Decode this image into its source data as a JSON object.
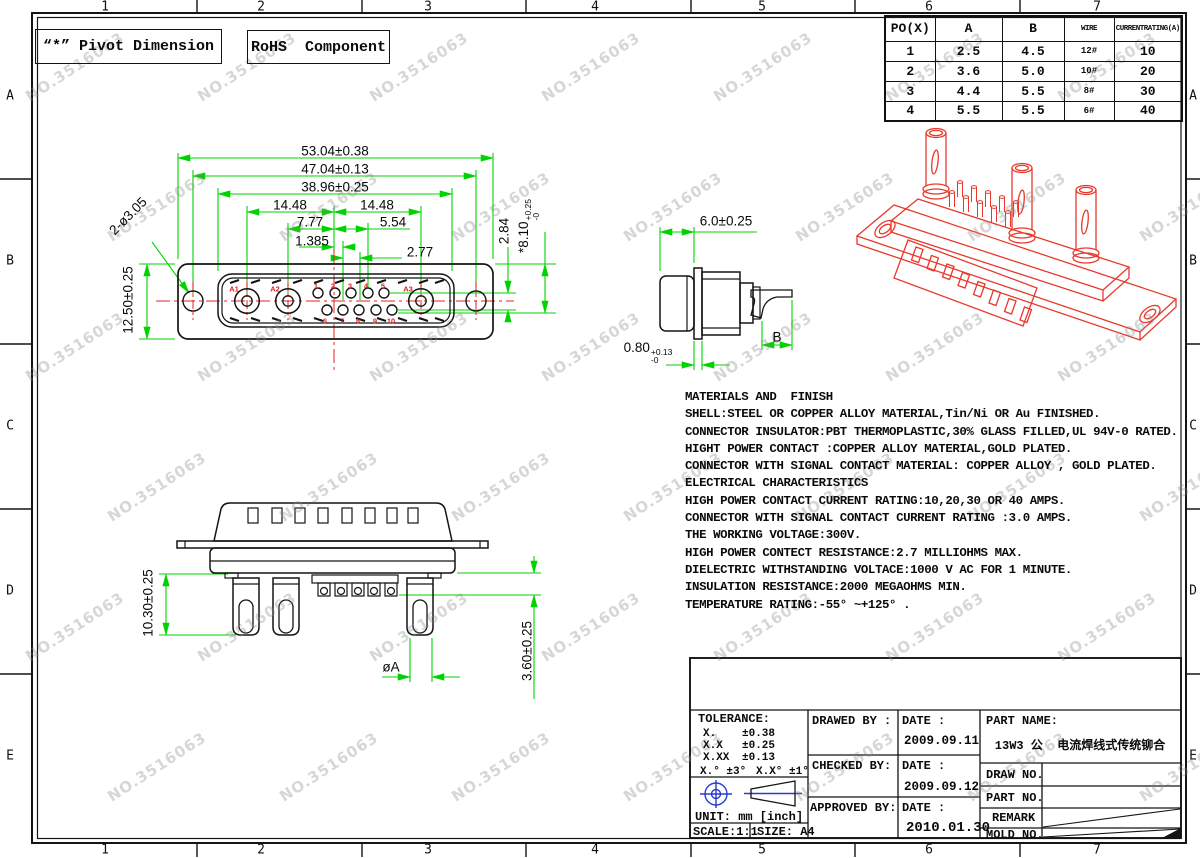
{
  "colors": {
    "dim_green": "#00d400",
    "center_red": "#ec2121",
    "iso_red": "#e8392c",
    "symbol_blue": "#2a3bd1"
  },
  "watermark": {
    "text": "NO.3516063"
  },
  "border": {
    "cols": [
      "1",
      "2",
      "3",
      "4",
      "5",
      "6",
      "7"
    ],
    "rows": [
      "A",
      "B",
      "C",
      "D",
      "E"
    ]
  },
  "callouts": {
    "pivot": "“*” Pivot Dimension",
    "rohs": "RoHS  Component"
  },
  "ratings_table": {
    "headers": [
      "PO(X)",
      "A",
      "B",
      "WIRE",
      "CURRENTRATING(A)"
    ],
    "rows": [
      [
        "1",
        "2.5",
        "4.5",
        "12#",
        "10"
      ],
      [
        "2",
        "3.6",
        "5.0",
        "10#",
        "20"
      ],
      [
        "3",
        "4.4",
        "5.5",
        "8#",
        "30"
      ],
      [
        "4",
        "5.5",
        "5.5",
        "6#",
        "40"
      ]
    ]
  },
  "front_view": {
    "dims": {
      "overall": "53.04±0.38",
      "mount": "47.04±0.13",
      "insert": "38.96±0.25",
      "left_pitch": "14.48",
      "right_pitch": "14.48",
      "a2_center": "7.77",
      "pin_span": "5.54",
      "row_offset": "1.385",
      "pin_pitch": "2.77",
      "row_gap": "2.84",
      "insert_h": "*8.10",
      "insert_h_up": "+0.25",
      "insert_h_dn": "-0",
      "shell_h": "12.50±0.25",
      "mount_holes": "2-ø3.05"
    },
    "contacts": [
      "A1",
      "A2",
      "A3"
    ],
    "pins_top": [
      "1",
      "2",
      "3",
      "4",
      "5"
    ],
    "pins_bottom": [
      "6",
      "7",
      "8",
      "9",
      "10"
    ]
  },
  "side_view": {
    "dims": {
      "depth": "6.0±0.25",
      "flange": "0.80",
      "flange_up": "+0.13",
      "flange_dn": "-0",
      "tail": "B"
    }
  },
  "bottom_view": {
    "dims": {
      "pin_len": "10.30±0.25",
      "pin_dia": "øA",
      "comb": "3.60±0.25"
    }
  },
  "notes": {
    "lines": [
      "MATERIALS AND  FINISH",
      "SHELL:STEEL OR COPPER ALLOY MATERIAL,Tin/Ni OR Au FINISHED.",
      "CONNECTOR INSULATOR:PBT THERMOPLASTIC,30% GLASS FILLED,UL 94V-0 RATED.",
      "HIGHT POWER CONTACT :COPPER ALLOY MATERIAL,GOLD PLATED.",
      "CONNECTOR WITH SIGNAL CONTACT MATERIAL: COPPER ALLOY , GOLD PLATED.",
      "ELECTRICAL CHARACTERISTICS",
      "HIGH POWER CONTACT CURRENT RATING:10,20,30 OR 40 AMPS.",
      "CONNECTOR WITH SIGNAL CONTACT CURRENT RATING :3.0 AMPS.",
      "THE WORKING VOLTAGE:300V.",
      "HIGH POWER CONTECT RESISTANCE:2.7 MILLIOHMS MAX.",
      "DIELECTRIC WITHSTANDING VOLTACE:1000 V AC FOR 1 MINUTE.",
      "INSULATION RESISTANCE:2000 MEGAOHMS MIN.",
      "TEMPERATURE RATING:-55° ~+125° ."
    ]
  },
  "title_block": {
    "tolerance_title": "TOLERANCE:",
    "tol1l": "X.",
    "tol1r": "±0.38",
    "tol2l": "X.X",
    "tol2r": "±0.25",
    "tol3l": "X.XX",
    "tol3r": "±0.13",
    "tol_ang1": "X.° ±3°",
    "tol_ang2": "X.X° ±1°",
    "unit": "UNIT: mm [inch]",
    "scale": "SCALE:1:1",
    "size": "SIZE: A4",
    "drawed_label": "DRAWED BY :",
    "checked_label": "CHECKED BY:",
    "approved_label": "APPROVED BY:",
    "date_label": "DATE :",
    "date_drawed": "2009.09.11",
    "date_checked": "2009.09.12",
    "date_approved": "2010.01.30",
    "part_name_label": "PART NAME:",
    "part_name_value": "13W3 公  电流焊线式传统铆合",
    "draw_no_label": "DRAW NO.",
    "part_no_label": "PART NO.",
    "remark_label": "REMARK",
    "mold_no_label": "MOLD NO."
  }
}
